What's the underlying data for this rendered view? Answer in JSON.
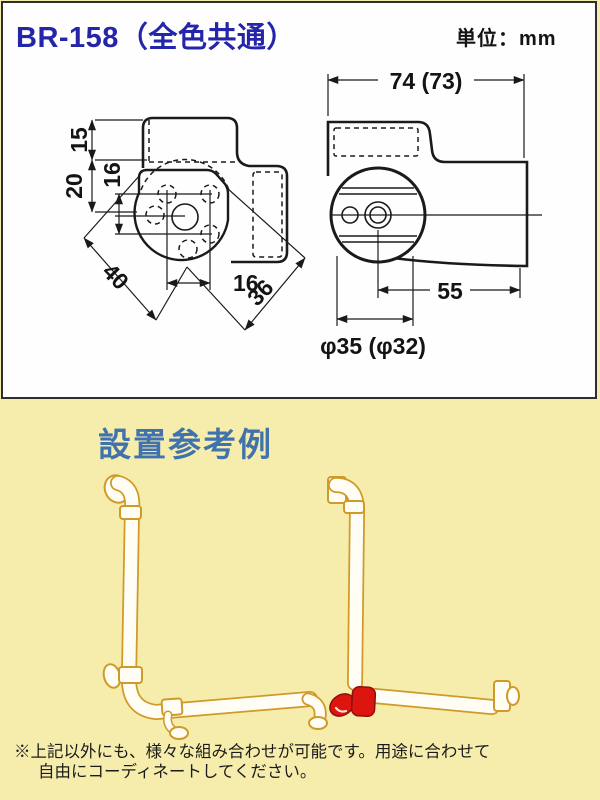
{
  "header": {
    "product_code": "BR-158（全色共通）",
    "unit_label": "単位：mm"
  },
  "drawing": {
    "front_view": {
      "dims": {
        "top_offset": "15",
        "center_offset": "20",
        "hole_pitch_vertical": "16",
        "hole_pitch_horizontal": "16",
        "plate_diag_left": "40",
        "plate_diag_right": "36"
      }
    },
    "side_view": {
      "dims": {
        "total_width": "74 (73)",
        "wall_to_center": "55",
        "tube_diameter": "φ35 (φ32)"
      }
    }
  },
  "example": {
    "title": "設置参考例",
    "note_line1": "※上記以外にも、様々な組み合わせが可能です。用途に合わせて",
    "note_line2": "自由にコーディネートしてください。"
  },
  "colors": {
    "page_bg": "#f6edad",
    "panel_bg": "#fefefe",
    "panel_border": "#2e2e2e",
    "title_blue": "#2525aa",
    "section_blue": "#4073ad",
    "line_black": "#1a1a1a",
    "rail_outline": "#cf9a28",
    "rail_fill": "#fffdf4",
    "highlight_red": "#dc150e"
  }
}
